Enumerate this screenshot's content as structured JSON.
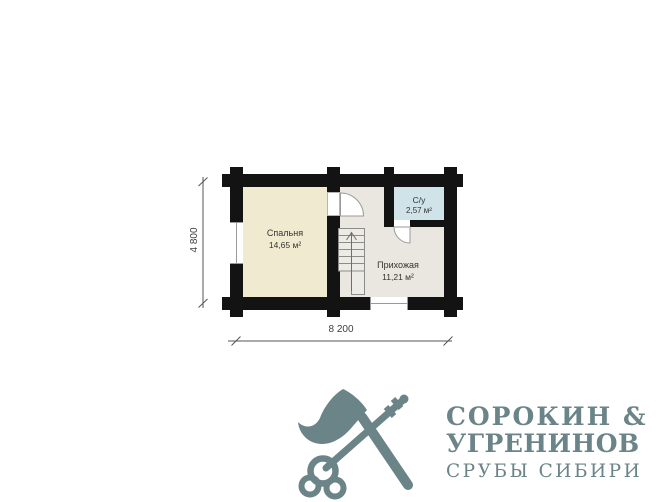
{
  "page": {
    "background": "#ffffff"
  },
  "floor_plan": {
    "wall_color": "#131313",
    "rooms": [
      {
        "id": "bedroom",
        "name": "Спальня",
        "area": "14,65 м²",
        "fill": "#f0ebd0"
      },
      {
        "id": "hallway",
        "name": "Прихожая",
        "area": "11,21 м²",
        "fill": "#e9e7e0"
      },
      {
        "id": "bathroom",
        "name": "С/у",
        "area": "2,57 м²",
        "fill": "#cfe3e8"
      }
    ],
    "dimensions": {
      "width_label": "8 200",
      "height_label": "4 800"
    },
    "features": [
      "staircase-up-arrow",
      "bedroom-door",
      "bathroom-door",
      "window-left-wall",
      "entrance-opening-bottom-wall"
    ]
  },
  "logo": {
    "icon": "crossed-axe-and-key",
    "title_line1": "СОРОКИН &",
    "title_line2": "УГРЕНИНОВ",
    "subtitle": "СРУБЫ СИБИРИ",
    "color": "#6b8487"
  }
}
